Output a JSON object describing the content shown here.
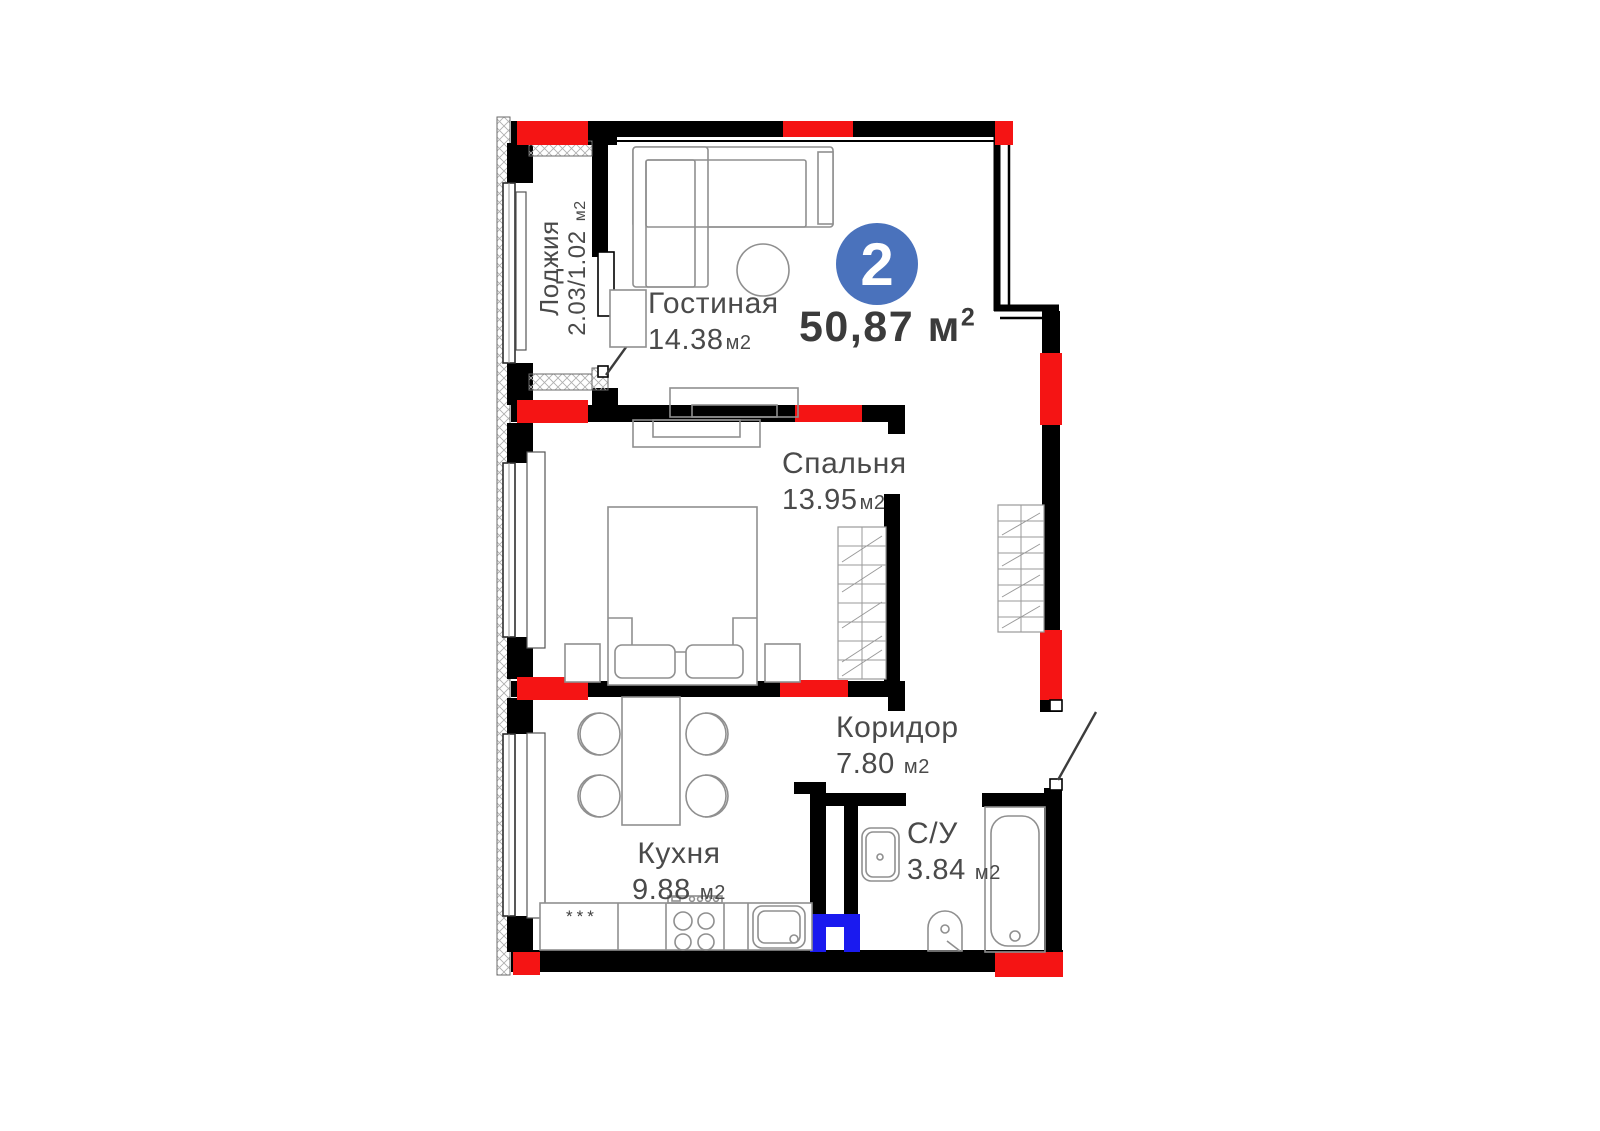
{
  "badge": {
    "rooms_count": "2",
    "total_area": "50,87",
    "unit_base": "м",
    "unit_sup": "2"
  },
  "rooms": [
    {
      "id": "loggia",
      "name": "Лоджия",
      "area": "2.03/1.02",
      "unit": "м2"
    },
    {
      "id": "living_room",
      "name": "Гостиная",
      "area": "14.38",
      "unit": "м2"
    },
    {
      "id": "bedroom",
      "name": "Спальня",
      "area": "13.95",
      "unit": "м2"
    },
    {
      "id": "corridor",
      "name": "Коридор",
      "area": "7.80",
      "unit": "м2"
    },
    {
      "id": "kitchen",
      "name": "Кухня",
      "area": "9.88",
      "unit": "м2"
    },
    {
      "id": "bathroom",
      "name": "С/У",
      "area": "3.84",
      "unit": "м2"
    }
  ],
  "fixtures": {
    "fridge_marking": "***"
  },
  "colors": {
    "wall": "#000000",
    "structural_column": "#f51414",
    "vent_duct": "#1a1aef",
    "badge": "#4a72bc",
    "label_text": "#4a4a4a",
    "furniture_line": "#8f8f8f"
  }
}
